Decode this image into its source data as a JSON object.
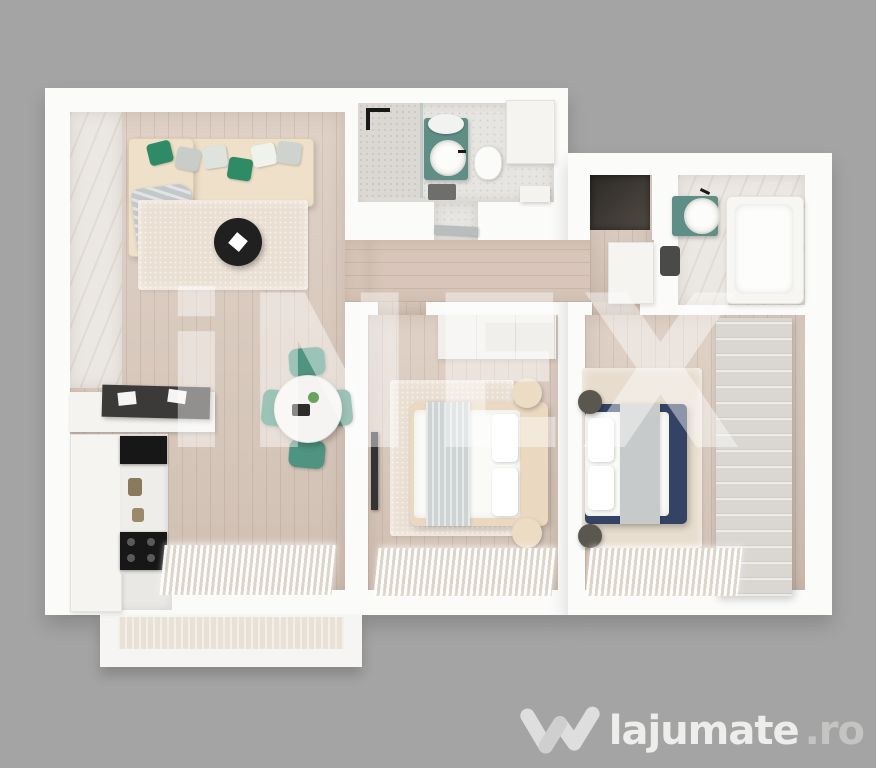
{
  "page": {
    "background_color": "#a4a4a4"
  },
  "watermark": {
    "text": "iNEX",
    "color": "#ffffff",
    "opacity": "44%"
  },
  "brand": {
    "name": "lajumate",
    "tld": ".ro",
    "icon": "lajumate-check-icon",
    "name_color": "#ededeb",
    "tld_color": "#c4c4c2"
  },
  "floorplan": {
    "type": "3d-apartment-top-view-render",
    "rooms": [
      {
        "id": "living-room",
        "features": [
          "corner-sofa-beige",
          "green-gray-pillows",
          "black-round-coffee-table",
          "round-dining-table-4-green-chairs",
          "tv-sideboard",
          "kitchen-with-cooktop",
          "marble-accent-wall",
          "window-curtains"
        ]
      },
      {
        "id": "main-bathroom",
        "features": [
          "walk-in-shower",
          "teal-vanity-round-sink",
          "mirror",
          "toilet",
          "cabinet",
          "dark-mat"
        ]
      },
      {
        "id": "entry-hall",
        "features": [
          "dark-door-mat",
          "white-dresser"
        ]
      },
      {
        "id": "second-bathroom",
        "features": [
          "teal-vanity-round-sink",
          "bathtub",
          "toilet"
        ]
      },
      {
        "id": "hallway",
        "features": [
          "open-bathroom-door"
        ]
      },
      {
        "id": "bedroom-1",
        "features": [
          "beige-double-bed",
          "white-bedding",
          "round-beige-nightstands",
          "wardrobe",
          "rug",
          "wall-tv",
          "window-curtains"
        ]
      },
      {
        "id": "bedroom-2",
        "features": [
          "navy-double-bed",
          "white-bedding",
          "dark-round-poufs",
          "large-slatted-wardrobe",
          "rug",
          "window-curtains"
        ]
      },
      {
        "id": "balcony",
        "features": []
      }
    ],
    "palette": {
      "walls": "#fbfbfa",
      "wood_floor": "#d9c8bb",
      "accent_green": "#4f9480",
      "teal_vanity": "#5f8e86",
      "bed_navy": "#344364",
      "sofa_beige": "#eee0c9",
      "dark_furniture": "#202020",
      "rug_cream": "#eadfd3"
    }
  }
}
